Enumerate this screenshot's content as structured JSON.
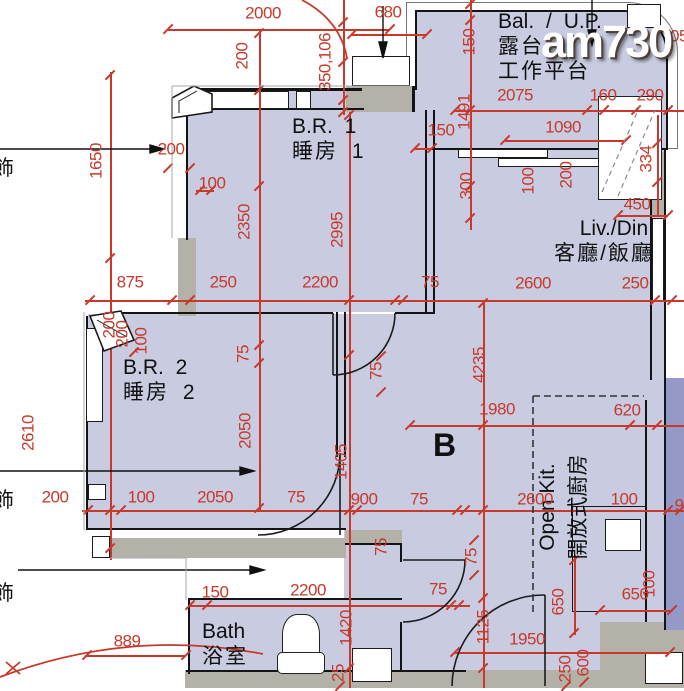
{
  "watermark": {
    "text": "am730"
  },
  "unit": {
    "label": "B"
  },
  "rooms": {
    "br1": {
      "en": "B.R. 1",
      "zh": "睡房 1"
    },
    "br2": {
      "en": "B.R. 2",
      "zh": "睡房 2"
    },
    "livdin": {
      "en": "Liv./Din.",
      "zh": "客廳/飯廳"
    },
    "bal": {
      "en": "Bal. / U.P.",
      "zh_1": "露台",
      "zh_2": "工作平台"
    },
    "openkit": {
      "en": "Open Kit.",
      "zh": "開放式廚房"
    },
    "bath": {
      "en": "Bath",
      "zh": "浴室"
    }
  },
  "partial_labels": {
    "left_1": "飾",
    "left_2": "飾",
    "left_3": "飾"
  },
  "colors": {
    "room_fill": "#c9cce1",
    "adjacent_fill": "#9599c7",
    "wall_gray": "#b4b1a9",
    "dim_red": "#c6392b",
    "line_black": "#141414"
  },
  "dimensions": [
    {
      "t": "2000",
      "x": 263,
      "y": 13,
      "o": 0
    },
    {
      "t": "680",
      "x": 388,
      "y": 12,
      "o": 0
    },
    {
      "t": "350,106",
      "x": 325,
      "y": 62,
      "o": 1
    },
    {
      "t": "200",
      "x": 242,
      "y": 56,
      "o": 1
    },
    {
      "t": "1650",
      "x": 96,
      "y": 161,
      "o": 1
    },
    {
      "t": "150",
      "x": 441,
      "y": 130,
      "o": 0
    },
    {
      "t": "1491",
      "x": 464,
      "y": 112,
      "o": 1
    },
    {
      "t": "150",
      "x": 469,
      "y": 42,
      "o": 1
    },
    {
      "t": "2075",
      "x": 515,
      "y": 95,
      "o": 0
    },
    {
      "t": "160",
      "x": 603,
      "y": 95,
      "o": 0
    },
    {
      "t": "290",
      "x": 650,
      "y": 95,
      "o": 0
    },
    {
      "t": "1090",
      "x": 563,
      "y": 127,
      "o": 0
    },
    {
      "t": "05",
      "x": 679,
      "y": 36,
      "o": 0
    },
    {
      "t": "200",
      "x": 171,
      "y": 149,
      "o": 0
    },
    {
      "t": "100",
      "x": 212,
      "y": 183,
      "o": 0
    },
    {
      "t": "300",
      "x": 466,
      "y": 186,
      "o": 1
    },
    {
      "t": "100",
      "x": 528,
      "y": 181,
      "o": 1
    },
    {
      "t": "200",
      "x": 566,
      "y": 175,
      "o": 1
    },
    {
      "t": "334",
      "x": 646,
      "y": 159,
      "o": 1
    },
    {
      "t": "450",
      "x": 637,
      "y": 204,
      "o": 0
    },
    {
      "t": "2350",
      "x": 244,
      "y": 222,
      "o": 1
    },
    {
      "t": "2995",
      "x": 337,
      "y": 230,
      "o": 1
    },
    {
      "t": "875",
      "x": 130,
      "y": 282,
      "o": 0
    },
    {
      "t": "250",
      "x": 223,
      "y": 282,
      "o": 0
    },
    {
      "t": "2200",
      "x": 320,
      "y": 282,
      "o": 0
    },
    {
      "t": "75",
      "x": 430,
      "y": 282,
      "o": 0
    },
    {
      "t": "2600",
      "x": 533,
      "y": 283,
      "o": 0
    },
    {
      "t": "250",
      "x": 635,
      "y": 283,
      "o": 0
    },
    {
      "t": "200",
      "x": 109,
      "y": 325,
      "o": 1
    },
    {
      "t": "200",
      "x": 122,
      "y": 334,
      "o": 1
    },
    {
      "t": "100",
      "x": 141,
      "y": 341,
      "o": 1
    },
    {
      "t": "2610",
      "x": 28,
      "y": 433,
      "o": 1
    },
    {
      "t": "75",
      "x": 243,
      "y": 354,
      "o": 1
    },
    {
      "t": "75",
      "x": 376,
      "y": 371,
      "o": 1
    },
    {
      "t": "2050",
      "x": 245,
      "y": 431,
      "o": 1
    },
    {
      "t": "4235",
      "x": 479,
      "y": 365,
      "o": 1
    },
    {
      "t": "1405",
      "x": 341,
      "y": 462,
      "o": 1
    },
    {
      "t": "1980",
      "x": 497,
      "y": 409,
      "o": 0
    },
    {
      "t": "620",
      "x": 627,
      "y": 410,
      "o": 0
    },
    {
      "t": "200",
      "x": 55,
      "y": 497,
      "o": 0
    },
    {
      "t": "100",
      "x": 141,
      "y": 497,
      "o": 0
    },
    {
      "t": "2050",
      "x": 215,
      "y": 497,
      "o": 0
    },
    {
      "t": "75",
      "x": 296,
      "y": 497,
      "o": 0
    },
    {
      "t": "900",
      "x": 364,
      "y": 499,
      "o": 0
    },
    {
      "t": "75",
      "x": 419,
      "y": 499,
      "o": 0
    },
    {
      "t": "2600",
      "x": 535,
      "y": 499,
      "o": 0
    },
    {
      "t": "100",
      "x": 624,
      "y": 499,
      "o": 0
    },
    {
      "t": "9",
      "x": 679,
      "y": 505,
      "o": 0
    },
    {
      "t": "75",
      "x": 381,
      "y": 547,
      "o": 1
    },
    {
      "t": "75",
      "x": 471,
      "y": 557,
      "o": 1
    },
    {
      "t": "75",
      "x": 438,
      "y": 589,
      "o": 0
    },
    {
      "t": "650",
      "x": 558,
      "y": 602,
      "o": 1
    },
    {
      "t": "100",
      "x": 649,
      "y": 584,
      "o": 1
    },
    {
      "t": "650",
      "x": 635,
      "y": 594,
      "o": 0
    },
    {
      "t": "150",
      "x": 215,
      "y": 592,
      "o": 0
    },
    {
      "t": "2200",
      "x": 308,
      "y": 590,
      "o": 0
    },
    {
      "t": "1420",
      "x": 346,
      "y": 628,
      "o": 1
    },
    {
      "t": "1125",
      "x": 483,
      "y": 627,
      "o": 1
    },
    {
      "t": "1950",
      "x": 527,
      "y": 639,
      "o": 0
    },
    {
      "t": "889",
      "x": 127,
      "y": 641,
      "o": 0
    },
    {
      "t": "25",
      "x": 338,
      "y": 673,
      "o": 1
    },
    {
      "t": "250",
      "x": 565,
      "y": 669,
      "o": 1
    },
    {
      "t": "600",
      "x": 583,
      "y": 663,
      "o": 1
    }
  ]
}
